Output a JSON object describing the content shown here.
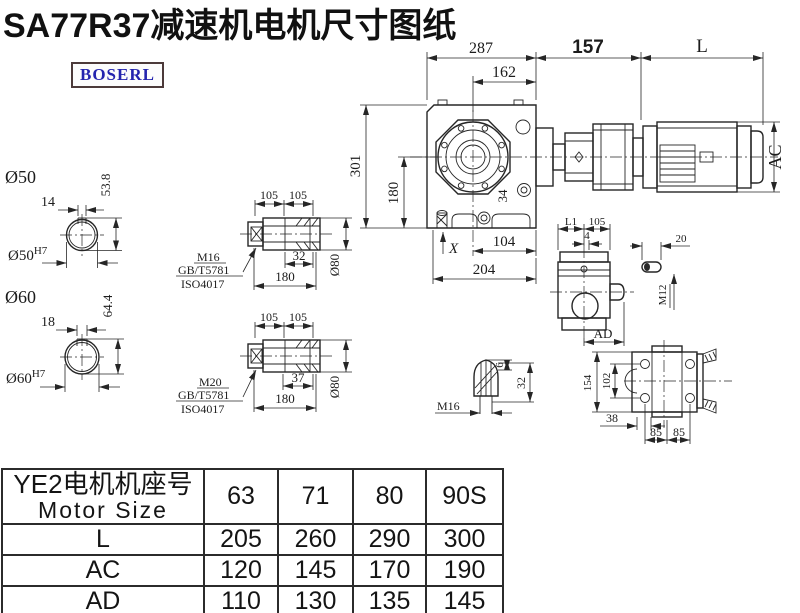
{
  "title": "SA77R37减速机电机尺寸图纸",
  "logo": {
    "text": "BOSERL"
  },
  "colors": {
    "line": "#262626",
    "logo_text": "#2424ae",
    "logo_border": "#4c3a3a",
    "background": "#ffffff"
  },
  "main_view": {
    "d287": "287",
    "d162": "162",
    "d157": "157",
    "dL": "L",
    "dAC": "AC",
    "d301": "301",
    "d180": "180",
    "d34": "34",
    "dX": "X",
    "d104": "104",
    "d204": "204"
  },
  "bore50": {
    "label": "Ø50",
    "key_width": "14",
    "key_height": "53.8",
    "fit": "Ø50",
    "fit_sup": "H7"
  },
  "bore60": {
    "label": "Ø60",
    "key_width": "18",
    "key_height": "64.4",
    "fit": "Ø60",
    "fit_sup": "H7"
  },
  "shaft_m16": {
    "d105a": "105",
    "d105b": "105",
    "d32": "32",
    "d180": "180",
    "dia": "Ø80",
    "thread": "M16",
    "std": "GB/T5781",
    "iso": "ISO4017"
  },
  "shaft_m20": {
    "d105a": "105",
    "d105b": "105",
    "d37": "37",
    "d180": "180",
    "dia": "Ø80",
    "thread": "M20",
    "std": "GB/T5781",
    "iso": "ISO4017"
  },
  "plug": {
    "d6": "6",
    "d32": "32",
    "thread": "M16"
  },
  "side_view": {
    "dL1": "L1",
    "d105": "105",
    "d4": "4",
    "dAD": "AD"
  },
  "key": {
    "d20": "20",
    "thread": "M12"
  },
  "bottom_view": {
    "d154": "154",
    "d102": "102",
    "d38": "38",
    "d85a": "85",
    "d85b": "85"
  },
  "table": {
    "header_line1": "YE2电机机座号",
    "header_line2": "Motor Size",
    "columns": [
      "63",
      "71",
      "80",
      "90S"
    ],
    "rows": [
      {
        "label": "L",
        "values": [
          "205",
          "260",
          "290",
          "300"
        ]
      },
      {
        "label": "AC",
        "values": [
          "120",
          "145",
          "170",
          "190"
        ]
      },
      {
        "label": "AD",
        "values": [
          "110",
          "130",
          "135",
          "145"
        ]
      }
    ]
  }
}
